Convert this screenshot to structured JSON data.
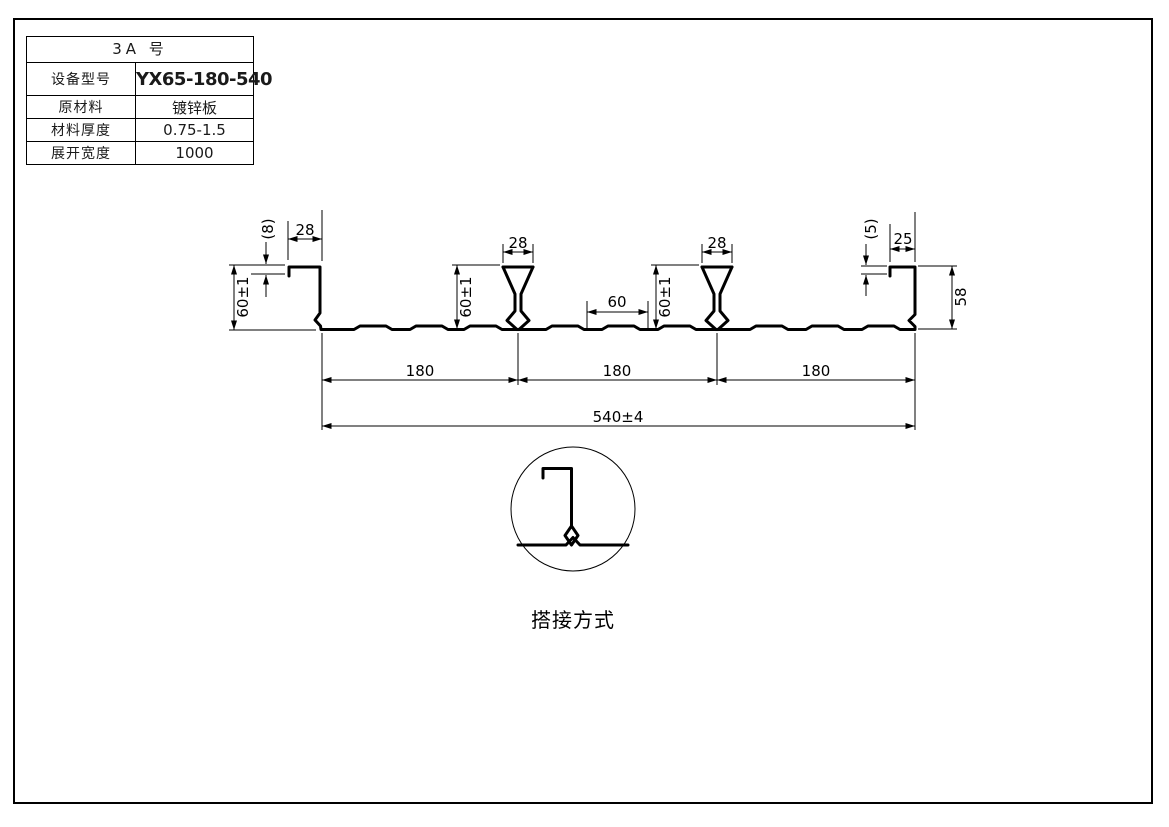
{
  "sheet": {
    "spec_table": {
      "title": "3A  号",
      "rows": [
        {
          "label": "设备型号",
          "value": "YX65-180-540"
        },
        {
          "label": "原材料",
          "value": "镀锌板"
        },
        {
          "label": "材料厚度",
          "value": "0.75-1.5"
        },
        {
          "label": "展开宽度",
          "value": "1000"
        }
      ]
    },
    "profile_dims": {
      "lip_left": "(8)",
      "top_left_width": "28",
      "height_left": "60±1",
      "rib1_width": "28",
      "rib1_height": "60±1",
      "mid_flat": "60",
      "rib2_width": "28",
      "rib2_height": "60±1",
      "lip_right": "(5)",
      "top_right_width": "25",
      "height_right": "58",
      "span_1": "180",
      "span_2": "180",
      "span_3": "180",
      "overall": "540±4"
    },
    "detail": {
      "caption": "搭接方式"
    },
    "colors": {
      "line": "#000000",
      "paper": "#ffffff"
    }
  }
}
